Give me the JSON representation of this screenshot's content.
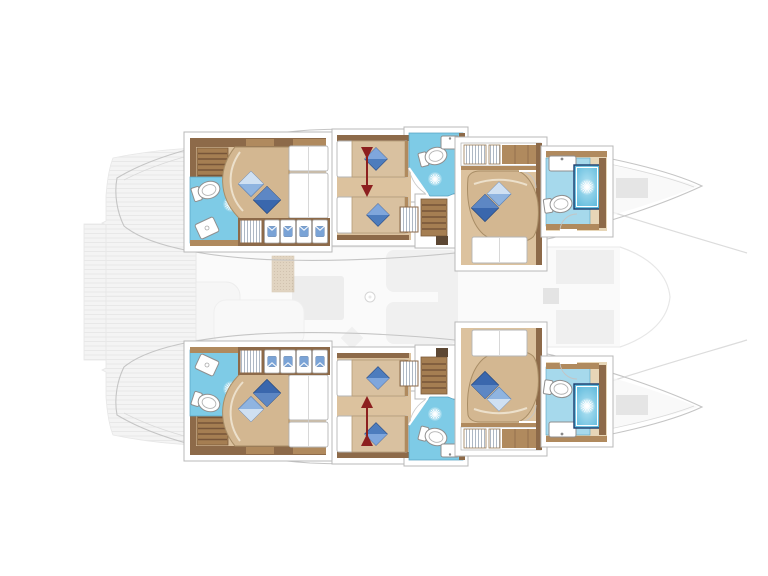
{
  "meta": {
    "app": "catamaran-deck-plan",
    "description": "Top-view interior layout plan of a sailing catamaran: two hulls each with three cabins and three bathrooms, ghosted saloon, cockpit and bow trampoline",
    "canvas": {
      "width": 768,
      "height": 576
    }
  },
  "colors": {
    "ghostFill": "#f4f4f4",
    "ghostLine": "#e7e7e7",
    "hullStroke": "#c5c5c5",
    "boxStroke": "#b8b8b8",
    "woodDark": "#8d6a49",
    "woodMid": "#b08a5e",
    "stairWood": "#a57e52",
    "stairTread": "#775539",
    "floorTan": "#dcc29e",
    "floorShade": "#d3b791",
    "bedTan": "#d9c1a0",
    "surStroke": "#a88d66",
    "bathBlue": "#7ecbe6",
    "bathLight": "#a6d9ec",
    "bathStroke": "#57a3c4",
    "showerBlue": "#66c2e0",
    "showerBorder": "#1c3d6e",
    "pillowDark": "#3a67ad",
    "pillowMid": "#4d7cbd",
    "pillowLight": "#8fb4e0",
    "fixWhite": "#ffffff",
    "fixStroke": "#8f8f8f",
    "arrowRed": "#8c1f1f",
    "shirtBlue": "#7aa3d6",
    "hangerGray": "#9aa6b5",
    "matBrown": "#c9b190"
  },
  "plan": {
    "hulls": [
      {
        "name": "starboard-hull",
        "cabins": [
          "aft-double-cabin",
          "mid-twin-cabin",
          "forward-double-cabin"
        ],
        "bathrooms": 3
      },
      {
        "name": "port-hull",
        "cabins": [
          "aft-double-cabin",
          "mid-twin-cabin",
          "forward-double-cabin"
        ],
        "bathrooms": 3
      }
    ],
    "ghost_features": [
      "swim-platform",
      "aft-cockpit-deck",
      "saloon",
      "galley",
      "mast-base",
      "bow-trampoline-lines"
    ],
    "icons": [
      "toilet-icon",
      "sink-icon",
      "shower-drain-icon",
      "shower-stall-icon",
      "pillow-icon",
      "hanging-clothes-icon",
      "shirt-icon",
      "stairs-icon",
      "convertible-bed-arrow-icon"
    ]
  }
}
